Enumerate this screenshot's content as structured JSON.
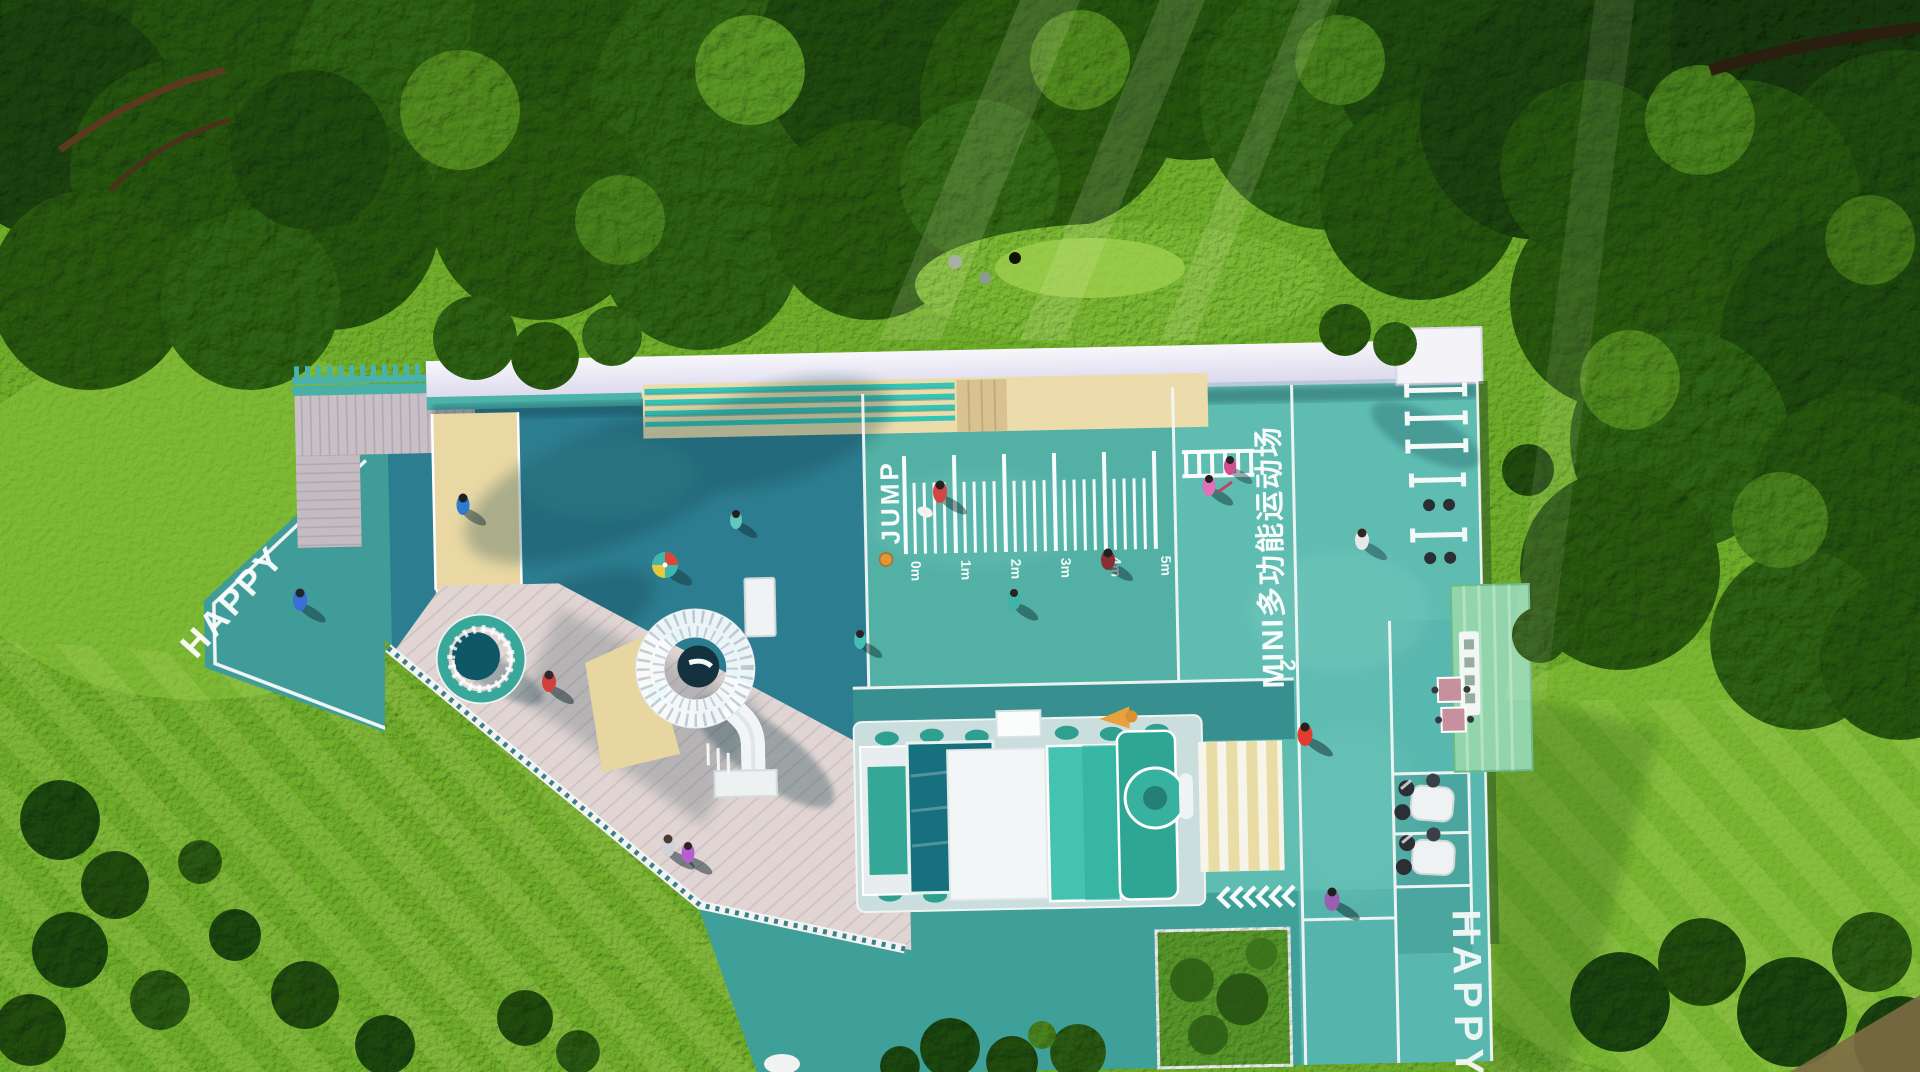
{
  "scene": {
    "description": "Aerial top-down 3D architectural rendering of a MINI multi-functional children's sports playground set in a lawn clearing surrounded by dense trees"
  },
  "markings": {
    "happy_left": "HAPPY",
    "happy_right": "HAPPY",
    "jump_label": "JUMP",
    "court_title": "MINI多功能运动场",
    "station_number": "2",
    "ruler_ticks": [
      "0m",
      "1m",
      "2m",
      "3m",
      "4m",
      "5m"
    ]
  },
  "palette": {
    "grass": "#6fae2b",
    "tree_dark": "#214c0e",
    "court_dark_teal": "#2d7d90",
    "court_teal": "#52b0a5",
    "court_light_teal": "#5ebcb1",
    "path_teal": "#3f9f99",
    "sand": "#e9d8a3",
    "deck_plank": "#ded3d2",
    "roof_white": "#f4f3f9",
    "train_teal": "#2fa693",
    "building_green": "#92d5aa",
    "marking_white": "#ffffff"
  }
}
